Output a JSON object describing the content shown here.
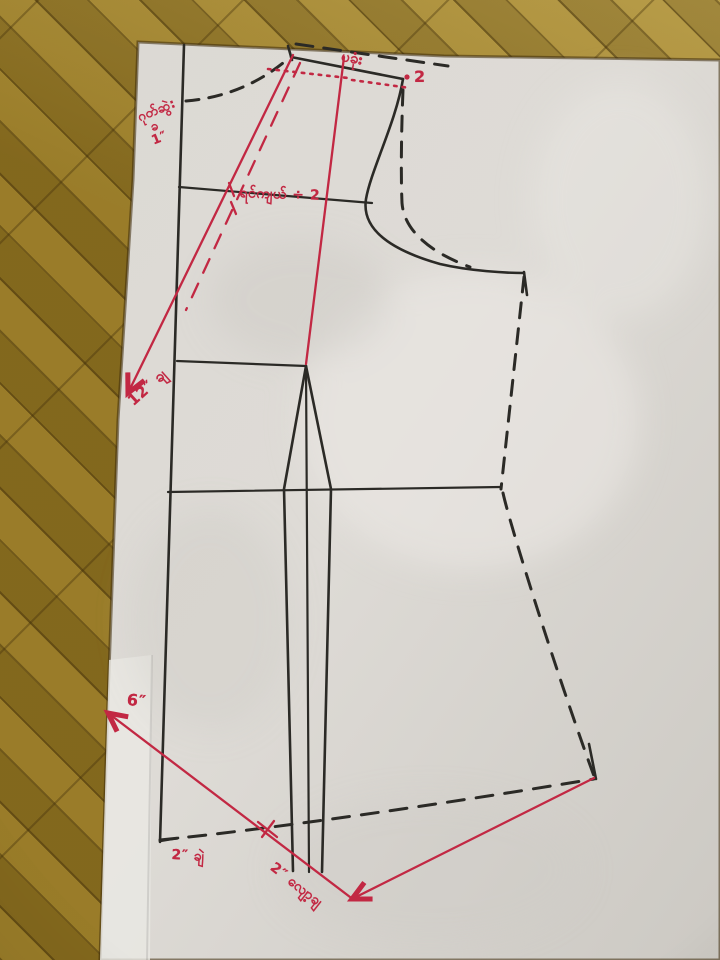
{
  "scene_title": "hand-drawn bodice sewing pattern on paper",
  "annotations": {
    "shoulder_word": "ပခုံး",
    "shoulder_point_value": "2",
    "back_neck_note": {
      "line1": "ဂုတ်ဆွဲ:",
      "line2": "ခ",
      "line3": "1″"
    },
    "chest_formula": "ရင်ကျယ် ÷ 2",
    "length_note": "12″ ချ",
    "hem_flare_note": "6″",
    "hem_left_note": "2″ ချဲ",
    "hem_drop_note": "2″ လျော့ချ"
  },
  "colors": {
    "ink_black": "#2b2a26",
    "ink_red": "#c22843",
    "paper": "#d8d5d0",
    "paper_light": "#e7e5e1",
    "wood": "#8e7120",
    "wood_light": "#b39a45"
  }
}
